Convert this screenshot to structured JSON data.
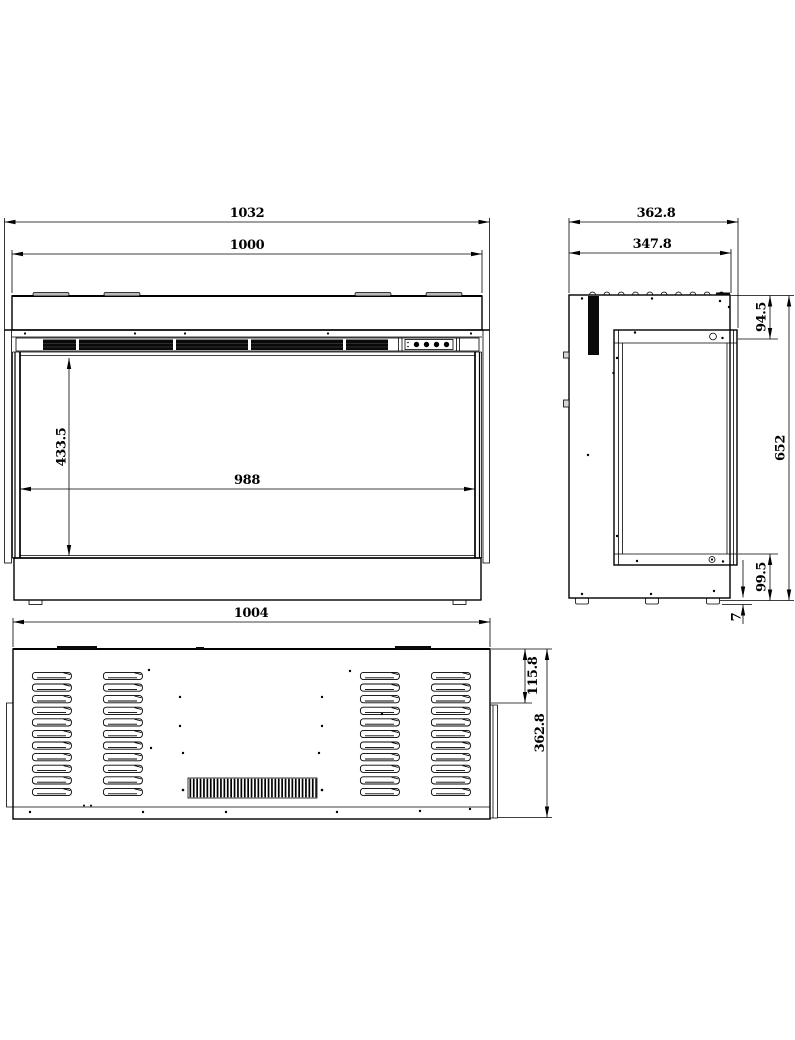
{
  "drawing": {
    "type": "three-view technical drawing of an electric fireplace insert",
    "colors": {
      "line": "#000000",
      "background": "#ffffff",
      "grille_fill": "#0a0a0a"
    },
    "views": {
      "front": {
        "dims": {
          "overall_width": "1032",
          "inner_width": "1000",
          "opening_height": "433.5",
          "opening_width": "988"
        }
      },
      "side": {
        "dims": {
          "overall_depth": "362.8",
          "body_depth": "347.8",
          "top_inset": "94.5",
          "overall_height": "652",
          "bottom_inset": "99.5",
          "foot_height": "7"
        }
      },
      "rear": {
        "dims": {
          "overall_width": "1004",
          "corner_inset": "115.8",
          "overall_depth": "362.8"
        }
      }
    }
  }
}
